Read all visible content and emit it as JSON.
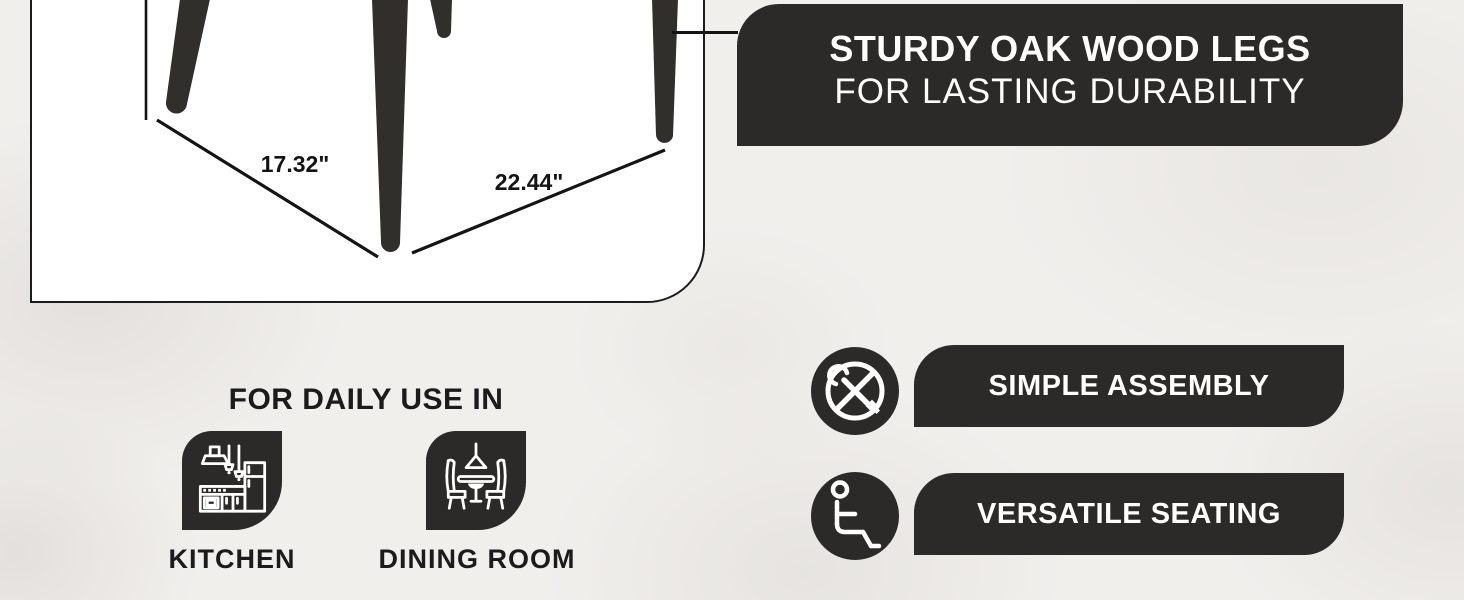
{
  "page": {
    "background_color": "#f1efec",
    "accent_dark": "#2b2a28"
  },
  "product_panel": {
    "dim_width_label": "17.32\"",
    "dim_depth_label": "22.44\""
  },
  "banner": {
    "title": "STURDY OAK WOOD LEGS",
    "subtitle": "FOR LASTING DURABILITY"
  },
  "daily_use": {
    "heading": "FOR DAILY USE IN",
    "items": [
      {
        "label": "KITCHEN",
        "icon": "kitchen-icon"
      },
      {
        "label": "DINING ROOM",
        "icon": "dining-room-icon"
      }
    ]
  },
  "features": [
    {
      "label": "SIMPLE ASSEMBLY",
      "icon": "no-tools-icon"
    },
    {
      "label": "VERSATILE SEATING",
      "icon": "seated-person-icon"
    }
  ]
}
